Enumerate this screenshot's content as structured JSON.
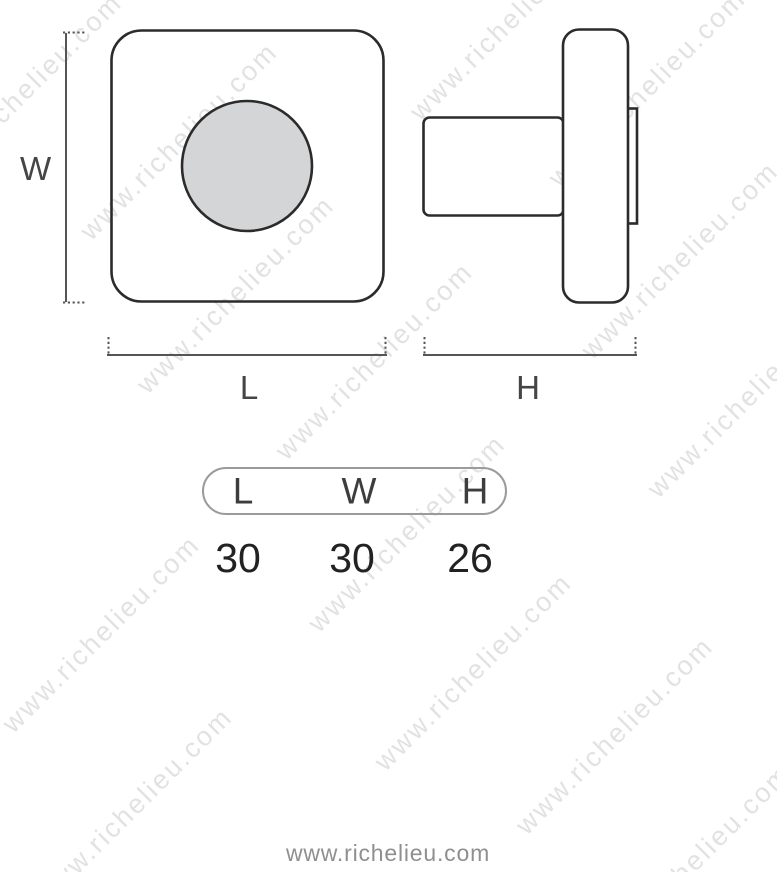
{
  "diagram": {
    "width_label": "W",
    "length_label": "L",
    "height_label": "H"
  },
  "table": {
    "headers": [
      "L",
      "W",
      "H"
    ],
    "values": [
      "30",
      "30",
      "26"
    ]
  },
  "footer": {
    "text": "www.richelieu.com"
  },
  "watermark": {
    "text": "www.richelieu.com"
  },
  "colors": {
    "background": "#ffffff",
    "outline": "#2b2b2b",
    "dimension": "#555555",
    "label": "#454545",
    "knob_fill": "#d4d5d6",
    "table_border": "#9b9b9b",
    "header_text": "#3d3d3d",
    "value_text": "#222222",
    "footer_text": "#8f8f8f",
    "watermark": "#e2e2e2"
  }
}
